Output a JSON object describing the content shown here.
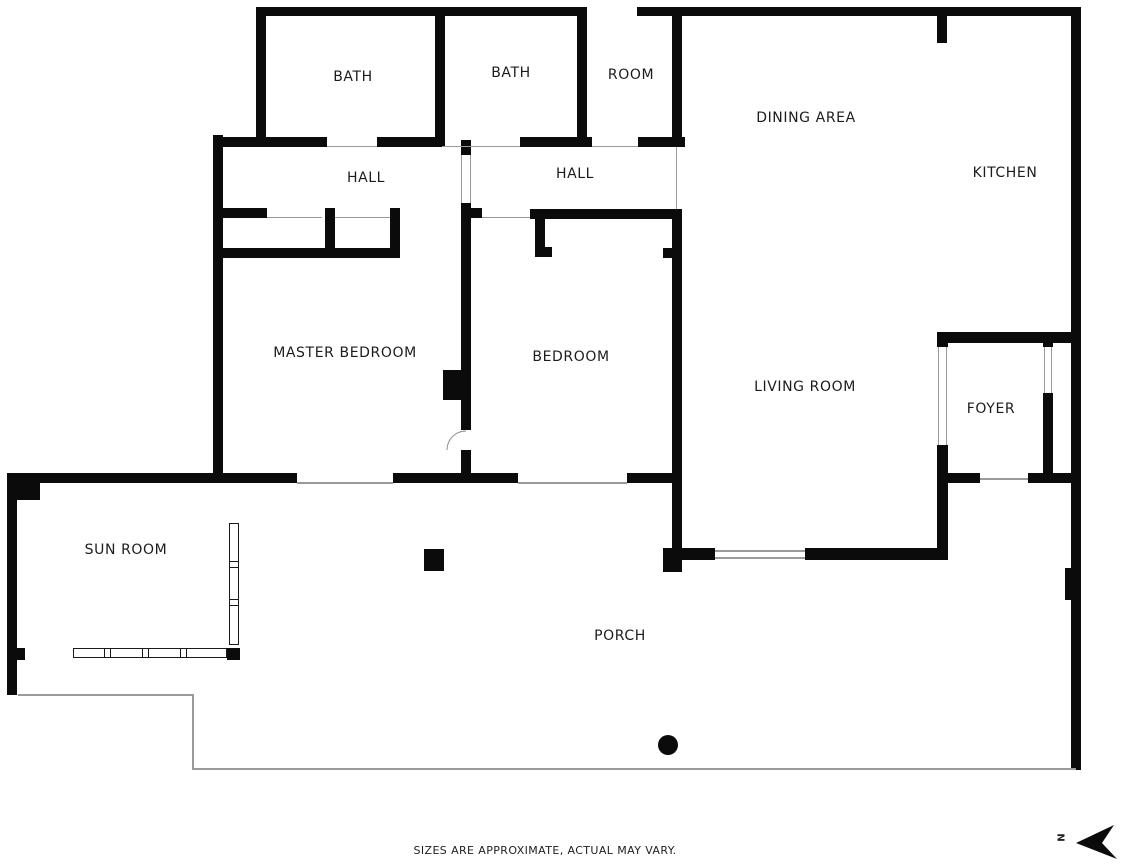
{
  "meta": {
    "disclaimer": "SIZES ARE APPROXIMATE, ACTUAL MAY VARY.",
    "north_label": "N"
  },
  "colors": {
    "wall": "#0b0b0b",
    "thin_line": "#9a9a9a",
    "label_text": "#1c1c1c",
    "background": "#ffffff"
  },
  "rooms": [
    {
      "label": "BATH",
      "x": 353,
      "y": 77
    },
    {
      "label": "BATH",
      "x": 511,
      "y": 73
    },
    {
      "label": "ROOM",
      "x": 631,
      "y": 75
    },
    {
      "label": "DINING AREA",
      "x": 806,
      "y": 118
    },
    {
      "label": "KITCHEN",
      "x": 1005,
      "y": 173
    },
    {
      "label": "HALL",
      "x": 366,
      "y": 178
    },
    {
      "label": "HALL",
      "x": 575,
      "y": 174
    },
    {
      "label": "MASTER BEDROOM",
      "x": 345,
      "y": 353
    },
    {
      "label": "BEDROOM",
      "x": 571,
      "y": 357
    },
    {
      "label": "LIVING ROOM",
      "x": 805,
      "y": 387
    },
    {
      "label": "FOYER",
      "x": 991,
      "y": 409
    },
    {
      "label": "SUN ROOM",
      "x": 126,
      "y": 550
    },
    {
      "label": "PORCH",
      "x": 620,
      "y": 636
    }
  ],
  "walls": [
    {
      "name": "top-wall-left",
      "x": 256,
      "y": 7,
      "w": 331,
      "h": 9
    },
    {
      "name": "top-wall-right",
      "x": 637,
      "y": 7,
      "w": 444,
      "h": 9
    },
    {
      "name": "right-outer-wall",
      "x": 1071,
      "y": 7,
      "w": 10,
      "h": 763
    },
    {
      "name": "bath1-left-wall",
      "x": 256,
      "y": 7,
      "w": 10,
      "h": 140
    },
    {
      "name": "left-outer-wall",
      "x": 213,
      "y": 135,
      "w": 10,
      "h": 348
    },
    {
      "name": "bath-divider-wall",
      "x": 435,
      "y": 7,
      "w": 10,
      "h": 140
    },
    {
      "name": "bath2-right-wall",
      "x": 577,
      "y": 12,
      "w": 10,
      "h": 133
    },
    {
      "name": "under-bath-wall-a",
      "x": 213,
      "y": 137,
      "w": 114,
      "h": 10
    },
    {
      "name": "under-bath-wall-b",
      "x": 377,
      "y": 137,
      "w": 65,
      "h": 10
    },
    {
      "name": "under-bath-wall-c",
      "x": 520,
      "y": 137,
      "w": 72,
      "h": 10
    },
    {
      "name": "under-room-wall",
      "x": 638,
      "y": 137,
      "w": 47,
      "h": 10
    },
    {
      "name": "room-right-wall",
      "x": 672,
      "y": 7,
      "w": 10,
      "h": 138
    },
    {
      "name": "hall1-bottom-stub",
      "x": 223,
      "y": 208,
      "w": 44,
      "h": 10
    },
    {
      "name": "closet-divider-wall",
      "x": 325,
      "y": 208,
      "w": 10,
      "h": 50
    },
    {
      "name": "closet-right-wall",
      "x": 390,
      "y": 208,
      "w": 10,
      "h": 50
    },
    {
      "name": "closet-bottom-wall",
      "x": 223,
      "y": 248,
      "w": 177,
      "h": 10
    },
    {
      "name": "hall-divider-upper",
      "x": 461,
      "y": 140,
      "w": 10,
      "h": 15
    },
    {
      "name": "hall-divider-main",
      "x": 461,
      "y": 203,
      "w": 10,
      "h": 227
    },
    {
      "name": "hall-divider-lower",
      "x": 461,
      "y": 450,
      "w": 10,
      "h": 33
    },
    {
      "name": "hall2-bottom-stub",
      "x": 471,
      "y": 208,
      "w": 11,
      "h": 10
    },
    {
      "name": "bedroom-top-wall",
      "x": 530,
      "y": 209,
      "w": 150,
      "h": 10
    },
    {
      "name": "bedroom-closet-left-wall",
      "x": 535,
      "y": 219,
      "w": 10,
      "h": 38
    },
    {
      "name": "bedroom-closet-left-foot",
      "x": 535,
      "y": 247,
      "w": 17,
      "h": 10
    },
    {
      "name": "bedroom-closet-right-stub",
      "x": 663,
      "y": 248,
      "w": 17,
      "h": 10
    },
    {
      "name": "bedroom-right-wall",
      "x": 672,
      "y": 209,
      "w": 10,
      "h": 339
    },
    {
      "name": "bedroom-right-corner-block",
      "x": 663,
      "y": 548,
      "w": 19,
      "h": 24
    },
    {
      "name": "livingroom-bottom-wall-a",
      "x": 678,
      "y": 548,
      "w": 37,
      "h": 12
    },
    {
      "name": "livingroom-bottom-wall-b",
      "x": 805,
      "y": 548,
      "w": 143,
      "h": 12
    },
    {
      "name": "livingroom-foyer-wall",
      "x": 937,
      "y": 445,
      "w": 11,
      "h": 115
    },
    {
      "name": "foyer-bottom-wall-a",
      "x": 948,
      "y": 473,
      "w": 32,
      "h": 10
    },
    {
      "name": "foyer-bottom-wall-b",
      "x": 1028,
      "y": 473,
      "w": 43,
      "h": 10
    },
    {
      "name": "kitchen-foyer-wall",
      "x": 937,
      "y": 332,
      "w": 144,
      "h": 11
    },
    {
      "name": "kitchen-foyer-wall-cap",
      "x": 937,
      "y": 332,
      "w": 11,
      "h": 15
    },
    {
      "name": "foyer-door-jamb",
      "x": 1043,
      "y": 338,
      "w": 10,
      "h": 9
    },
    {
      "name": "foyer-closet-wall",
      "x": 1043,
      "y": 393,
      "w": 10,
      "h": 90
    },
    {
      "name": "kitchen-divider-stub",
      "x": 937,
      "y": 15,
      "w": 10,
      "h": 28
    },
    {
      "name": "master-bottom-wall",
      "x": 393,
      "y": 473,
      "w": 125,
      "h": 10
    },
    {
      "name": "bedroom-bottom-wall",
      "x": 627,
      "y": 473,
      "w": 55,
      "h": 10
    },
    {
      "name": "master-divider-block",
      "x": 443,
      "y": 370,
      "w": 20,
      "h": 30
    },
    {
      "name": "sunroom-top-wall",
      "x": 7,
      "y": 473,
      "w": 290,
      "h": 10
    },
    {
      "name": "sunroom-corner-block",
      "x": 7,
      "y": 473,
      "w": 33,
      "h": 27
    },
    {
      "name": "sunroom-left-wall",
      "x": 7,
      "y": 500,
      "w": 10,
      "h": 195
    },
    {
      "name": "sunroom-left-bump",
      "x": 7,
      "y": 648,
      "w": 18,
      "h": 12
    },
    {
      "name": "sunroom-corner-block-br",
      "x": 227,
      "y": 648,
      "w": 13,
      "h": 12
    },
    {
      "name": "sunroom-window-cap",
      "x": 73,
      "y": 648,
      "w": 8,
      "h": 10
    },
    {
      "name": "porch-door-jamb",
      "x": 1065,
      "y": 568,
      "w": 9,
      "h": 32
    }
  ],
  "thin_lines": [
    {
      "name": "porch-edge-left",
      "x": 18,
      "y": 694,
      "w": 175,
      "h": 2
    },
    {
      "name": "porch-edge-step",
      "x": 192,
      "y": 694,
      "w": 2,
      "h": 75
    },
    {
      "name": "porch-edge-bottom",
      "x": 192,
      "y": 768,
      "w": 884,
      "h": 2
    },
    {
      "name": "bath1-door-sill",
      "x": 327,
      "y": 146,
      "w": 50,
      "h": 1
    },
    {
      "name": "bath2-door-sill",
      "x": 442,
      "y": 146,
      "w": 78,
      "h": 1
    },
    {
      "name": "room-door-sill",
      "x": 592,
      "y": 146,
      "w": 46,
      "h": 1
    },
    {
      "name": "master-door-sill",
      "x": 267,
      "y": 217,
      "w": 55,
      "h": 1
    },
    {
      "name": "closet-door-sill",
      "x": 335,
      "y": 217,
      "w": 55,
      "h": 1
    },
    {
      "name": "bedroom-door-sill",
      "x": 482,
      "y": 217,
      "w": 48,
      "h": 1
    },
    {
      "name": "hall-door-sill-a",
      "x": 461,
      "y": 155,
      "w": 1,
      "h": 48
    },
    {
      "name": "hall-door-sill-b",
      "x": 470,
      "y": 155,
      "w": 1,
      "h": 48
    },
    {
      "name": "hall2-opening-sill",
      "x": 676,
      "y": 147,
      "w": 1,
      "h": 62
    },
    {
      "name": "master-slider-line",
      "x": 297,
      "y": 482,
      "w": 96,
      "h": 2
    },
    {
      "name": "bedroom-slider-line",
      "x": 518,
      "y": 482,
      "w": 109,
      "h": 2
    },
    {
      "name": "livingroom-window-line-a",
      "x": 715,
      "y": 550,
      "w": 90,
      "h": 2
    },
    {
      "name": "livingroom-window-line-b",
      "x": 715,
      "y": 557,
      "w": 90,
      "h": 2
    },
    {
      "name": "foyer-porch-door-line",
      "x": 980,
      "y": 478,
      "w": 48,
      "h": 2
    },
    {
      "name": "foyer-opening-line-a",
      "x": 938,
      "y": 347,
      "w": 1,
      "h": 98
    },
    {
      "name": "foyer-opening-line-b",
      "x": 946,
      "y": 347,
      "w": 1,
      "h": 98
    },
    {
      "name": "foyer-closet-door-line-a",
      "x": 1044,
      "y": 347,
      "w": 1,
      "h": 46
    },
    {
      "name": "foyer-closet-door-line-b",
      "x": 1051,
      "y": 347,
      "w": 1,
      "h": 46
    }
  ],
  "windows": [
    {
      "name": "sunroom-bottom-window",
      "orientation": "h",
      "x": 73,
      "y": 648,
      "w": 154,
      "h": 10,
      "dividers": [
        104,
        142,
        180
      ]
    },
    {
      "name": "sunroom-right-window",
      "orientation": "v",
      "x": 229,
      "y": 523,
      "w": 10,
      "h": 122,
      "dividers": [
        561,
        599
      ]
    }
  ],
  "features": {
    "column_dot": {
      "x": 658,
      "y": 735,
      "d": 20
    },
    "porch_post": {
      "x": 424,
      "y": 549,
      "w": 20,
      "h": 22
    }
  }
}
